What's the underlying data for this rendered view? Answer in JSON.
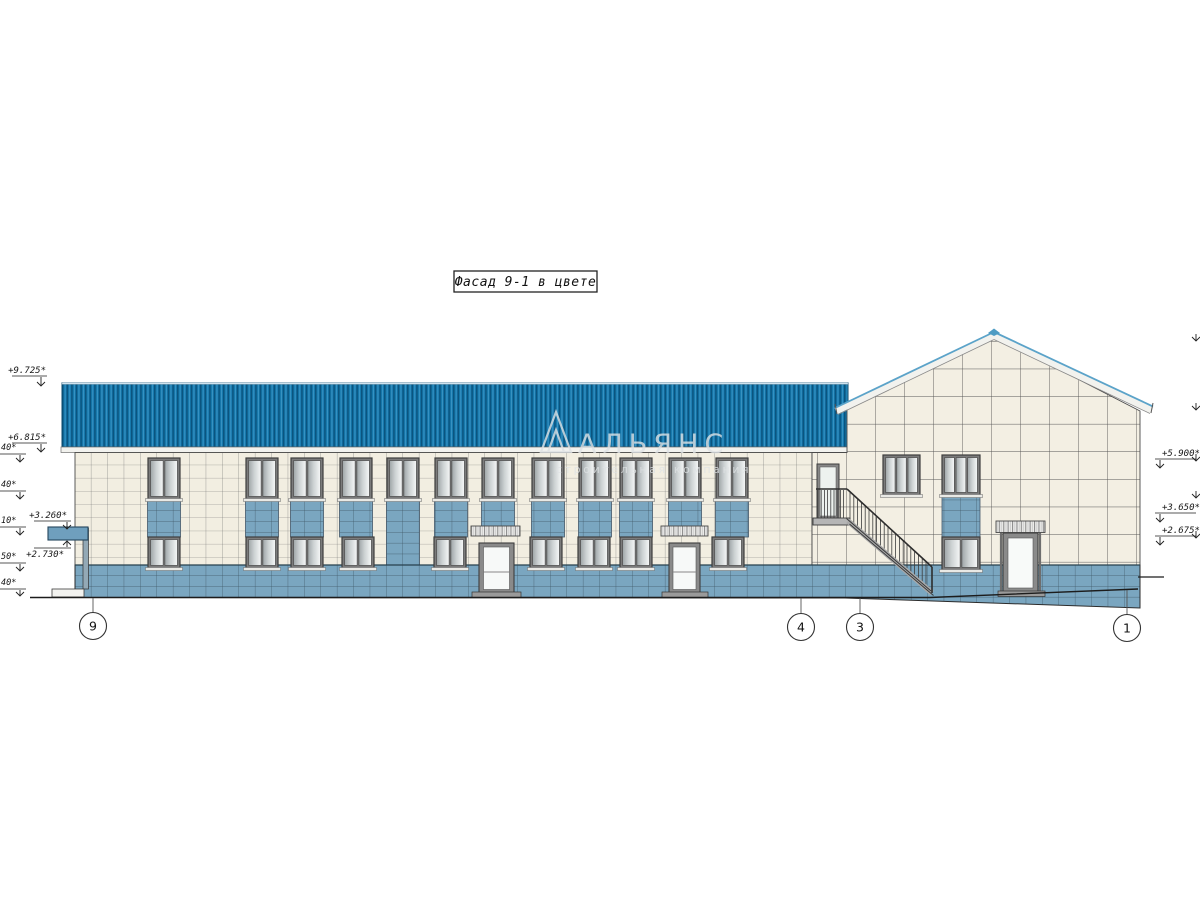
{
  "drawing": {
    "title_block": {
      "text": "Фасад 9-1 в цвете"
    },
    "watermark": {
      "title": "АЛЬЯНС",
      "subtitle": "строительная компания"
    },
    "levels": {
      "left": [
        "+9.725*",
        "+6.815*",
        "+3.260*",
        "+2.730*"
      ],
      "left_edge_fragments": [
        "40*",
        "40*",
        "10*",
        "50*",
        "40*"
      ],
      "right": [
        "+5.900*",
        "+3.650*",
        "+2.675*"
      ]
    },
    "grid_axes": [
      "9",
      "4",
      "3",
      "1"
    ],
    "colors": {
      "roof": "#1477ab",
      "roof_stripe": "#0b547f",
      "wall_tile": "#f2eee1",
      "band_tile": "#7aa6c0",
      "fascia": "#f2f2ee",
      "glass": "#d9dddd"
    }
  }
}
